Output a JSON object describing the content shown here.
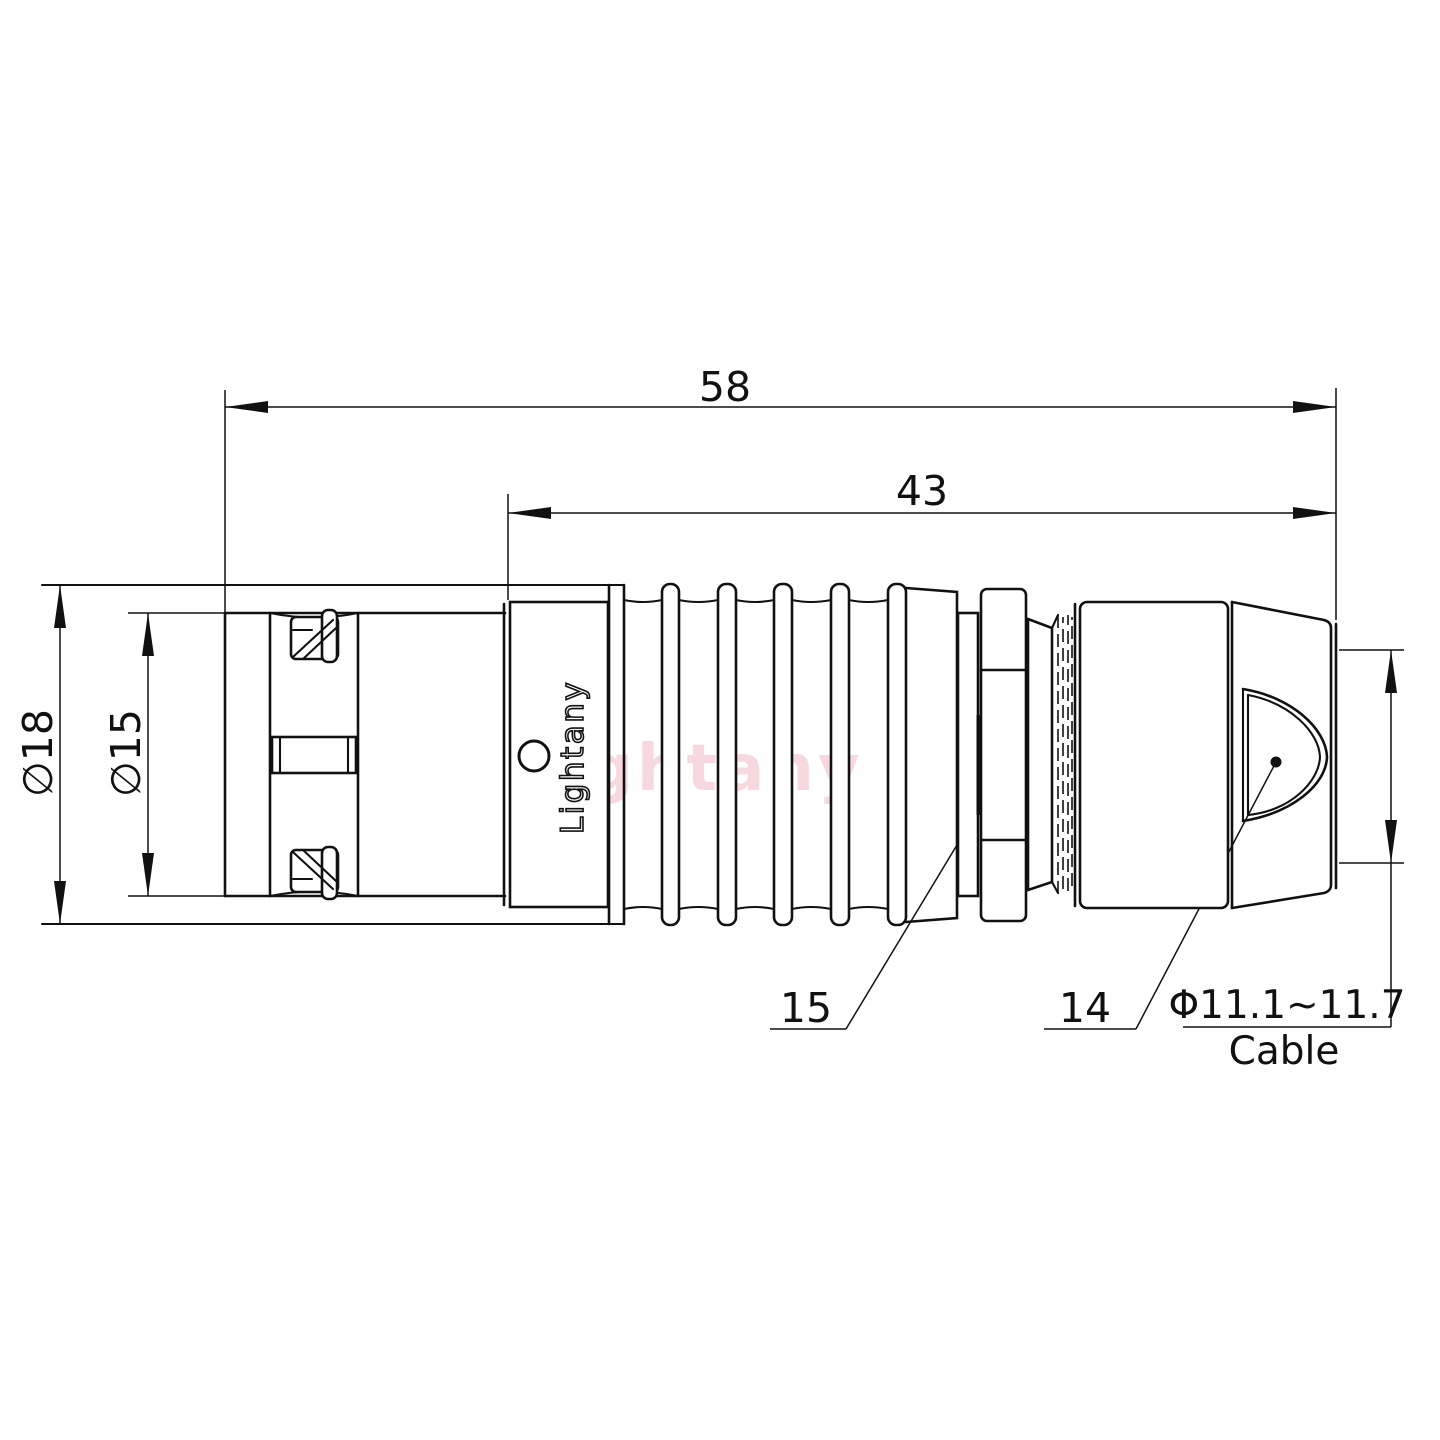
{
  "page": {
    "background": "#ffffff"
  },
  "colors": {
    "line": "#111111",
    "watermark": "#f2b9c4",
    "logo_fill": "#ffffff"
  },
  "watermark": {
    "text": "Lightany"
  },
  "connector": {
    "body_logo": "Lightany"
  },
  "dimensions": {
    "overall_length": "58",
    "rear_length": "43",
    "shell_diameter": "∅18",
    "nose_diameter": "∅15",
    "cable_diameter": "Φ11.1~11.7",
    "cable_caption": "Cable"
  },
  "part_labels": {
    "nut": "15",
    "rear_boot": "14"
  }
}
